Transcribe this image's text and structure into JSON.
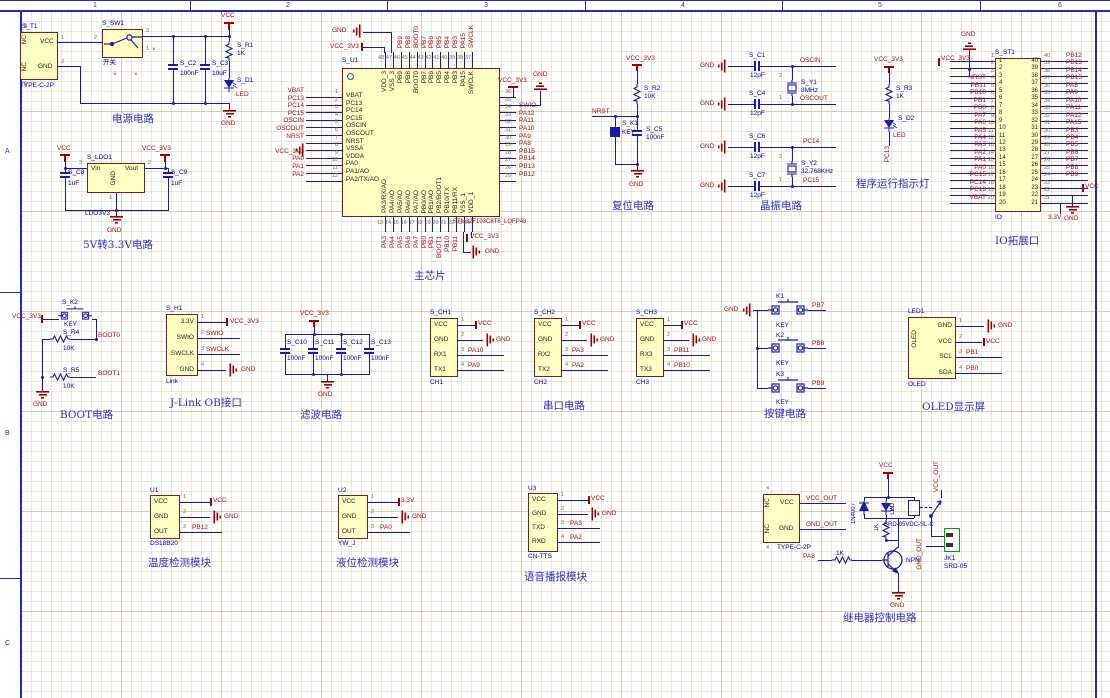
{
  "sheet": {
    "cols": [
      "1",
      "2",
      "3",
      "4",
      "5",
      "6"
    ],
    "rows": [
      "A",
      "B",
      "C"
    ]
  },
  "power": {
    "title": "电源电路",
    "vcc": "VCC",
    "gnd": "GND",
    "t1": {
      "ref": "S_T1",
      "part": "TYPE-C-2P",
      "nc": "NC",
      "vcc": "VCC",
      "gnd": "GND",
      "n1": "1",
      "n2": "2",
      "m0": "0"
    },
    "sw1": {
      "ref": "S_SW1",
      "val": "开关",
      "n1": "1",
      "n2": "2",
      "n3": "3"
    },
    "c2": {
      "ref": "S_C2",
      "val": "100nF"
    },
    "c3": {
      "ref": "S_C3",
      "val": "10uF"
    },
    "r1": {
      "ref": "S_R1",
      "val": "1K"
    },
    "d1": {
      "ref": "S_D1",
      "val": "LED"
    }
  },
  "ldo": {
    "title": "5V转3.3V电路",
    "vcc": "VCC",
    "vcc3v3": "VCC_3V3",
    "gnd": "GND",
    "ref": "S_LDO1",
    "part": "LDO3V3",
    "vin": "Vin",
    "vout": "Vout",
    "gndpin": "GND",
    "n1": "1",
    "n2": "2",
    "n3": "3",
    "c8": {
      "ref": "S_C8",
      "val": "1uF"
    },
    "c9": {
      "ref": "S_C9",
      "val": "1uF"
    }
  },
  "chip": {
    "ref": "S_U1",
    "part": "STM32F103C8T6_LQFP48",
    "title": "主芯片",
    "gnd": "GND",
    "vcc3v3": "VCC_3V3",
    "left": [
      {
        "n": "1",
        "name": "VBAT",
        "net": "VBAT"
      },
      {
        "n": "2",
        "name": "PC13",
        "net": "PC13"
      },
      {
        "n": "3",
        "name": "PC14",
        "net": "PC14"
      },
      {
        "n": "4",
        "name": "PC15",
        "net": "PC15"
      },
      {
        "n": "5",
        "name": "OSCIN",
        "net": "OSCIN"
      },
      {
        "n": "6",
        "name": "OSCOUT",
        "net": "OSCOUT"
      },
      {
        "n": "7",
        "name": "NRST",
        "net": "NRST"
      },
      {
        "n": "8",
        "name": "VSSA",
        "net": ""
      },
      {
        "n": "9",
        "name": "VDDA",
        "net": "VCC_3V3"
      },
      {
        "n": "10",
        "name": "PA0",
        "net": "PA0"
      },
      {
        "n": "11",
        "name": "PA1/AO",
        "net": "PA1"
      },
      {
        "n": "12",
        "name": "PA2/TX/AO",
        "net": "PA2"
      }
    ],
    "right": [
      {
        "n": "36",
        "name": "VDD_2",
        "net": ""
      },
      {
        "n": "35",
        "name": "VSS_2",
        "net": ""
      },
      {
        "n": "34",
        "name": "SWIO",
        "net": "SWIO"
      },
      {
        "n": "33",
        "name": "PA12/USB/DP",
        "net": "PA12"
      },
      {
        "n": "32",
        "name": "PA11/USB/DM",
        "net": "PA11"
      },
      {
        "n": "31",
        "name": "PA10/RX",
        "net": "PA10"
      },
      {
        "n": "30",
        "name": "PA9/TX",
        "net": "PA9"
      },
      {
        "n": "29",
        "name": "PA8",
        "net": "PA8"
      },
      {
        "n": "28",
        "name": "PB15",
        "net": "PB15"
      },
      {
        "n": "27",
        "name": "PB14",
        "net": "PB14"
      },
      {
        "n": "26",
        "name": "PB13",
        "net": "PB13"
      },
      {
        "n": "25",
        "name": "PB12",
        "net": "PB12"
      }
    ],
    "top": [
      {
        "n": "48",
        "name": "VDD_3",
        "net": ""
      },
      {
        "n": "47",
        "name": "VSS_3",
        "net": ""
      },
      {
        "n": "46",
        "name": "PB9",
        "net": "PB9"
      },
      {
        "n": "45",
        "name": "PB8",
        "net": "PB8"
      },
      {
        "n": "44",
        "name": "BOOT0",
        "net": "BOOT0"
      },
      {
        "n": "43",
        "name": "PB7",
        "net": "PB7"
      },
      {
        "n": "42",
        "name": "PB6",
        "net": "PB6"
      },
      {
        "n": "41",
        "name": "PB5",
        "net": "PB5"
      },
      {
        "n": "40",
        "name": "PB4",
        "net": "PB4"
      },
      {
        "n": "39",
        "name": "PB3",
        "net": "PB3"
      },
      {
        "n": "38",
        "name": "PA15",
        "net": "PA15"
      },
      {
        "n": "37",
        "name": "SWCLK",
        "net": "SWCLK"
      }
    ],
    "bottom": [
      {
        "n": "13",
        "name": "PA3/RX/AO",
        "net": "PA3"
      },
      {
        "n": "14",
        "name": "PA4/AO",
        "net": "PA4"
      },
      {
        "n": "15",
        "name": "PA5/AO",
        "net": "PA5"
      },
      {
        "n": "16",
        "name": "PA6/AO",
        "net": "PA6"
      },
      {
        "n": "17",
        "name": "PA7/AO",
        "net": "PA7"
      },
      {
        "n": "18",
        "name": "PB0/AO",
        "net": "PB0"
      },
      {
        "n": "19",
        "name": "PB1/AO",
        "net": "PB1"
      },
      {
        "n": "20",
        "name": "PB2/BOOT1",
        "net": "BOOT1"
      },
      {
        "n": "21",
        "name": "PB10/TX",
        "net": "PB10"
      },
      {
        "n": "22",
        "name": "PB11/RX",
        "net": "PB11"
      },
      {
        "n": "23",
        "name": "VSS_1",
        "net": ""
      },
      {
        "n": "24",
        "name": "VDD_1",
        "net": ""
      }
    ]
  },
  "reset": {
    "title": "复位电路",
    "vcc3v3": "VCC_3V3",
    "gnd": "GND",
    "nrst": "NRST",
    "r2": {
      "ref": "S_R2",
      "val": "10K"
    },
    "k1": {
      "ref": "S_K1",
      "val": "KEY"
    },
    "c5": {
      "ref": "S_C5",
      "val": "100nF"
    }
  },
  "crystal": {
    "title": "晶振电路",
    "gnd": "GND",
    "oscin": "OSCIN",
    "oscout": "OSCOUT",
    "pc14": "PC14",
    "pc15": "PC15",
    "c1": {
      "ref": "S_C1",
      "val": "12pF"
    },
    "c4": {
      "ref": "S_C4",
      "val": "12pF"
    },
    "c6": {
      "ref": "S_C6",
      "val": "12pF"
    },
    "c7": {
      "ref": "S_C7",
      "val": "12pF"
    },
    "y1": {
      "ref": "S_Y1",
      "val": "8MHz",
      "n1": "1",
      "n2": "2"
    },
    "y2": {
      "ref": "S_Y2",
      "val": "32.768KHz",
      "n1": "1",
      "n2": "2"
    }
  },
  "runled": {
    "title": "程序运行指示灯",
    "vcc3v3": "VCC_3V3",
    "r3": {
      "ref": "S_R3",
      "val": "1K"
    },
    "d2": {
      "ref": "S_D2",
      "val": "LED"
    },
    "net": "PC13"
  },
  "io": {
    "title": "IO拓展口",
    "ref": "S_ST1",
    "part": "IO",
    "gnd_top": "GND",
    "vcc3v3": "VCC_3V3",
    "vcc": "VCC",
    "gnd": "GND",
    "v33": "3.3V",
    "left": [
      {
        "n": "1",
        "net": ""
      },
      {
        "n": "2",
        "net": ""
      },
      {
        "n": "3",
        "net": ""
      },
      {
        "n": "4",
        "net": "NRST"
      },
      {
        "n": "5",
        "net": "PB11"
      },
      {
        "n": "6",
        "net": "PB10"
      },
      {
        "n": "7",
        "net": "PB1"
      },
      {
        "n": "8",
        "net": "PB0"
      },
      {
        "n": "9",
        "net": "PA7"
      },
      {
        "n": "10",
        "net": "PA6"
      },
      {
        "n": "11",
        "net": "PA5"
      },
      {
        "n": "12",
        "net": "PA4"
      },
      {
        "n": "13",
        "net": "PA3"
      },
      {
        "n": "14",
        "net": "PA2"
      },
      {
        "n": "15",
        "net": "PA1"
      },
      {
        "n": "16",
        "net": "PA0"
      },
      {
        "n": "17",
        "net": "PC15"
      },
      {
        "n": "18",
        "net": "PC14"
      },
      {
        "n": "19",
        "net": "PC13"
      },
      {
        "n": "20",
        "net": "VBAT"
      }
    ],
    "right": [
      {
        "n": "40",
        "net": "PB12"
      },
      {
        "n": "39",
        "net": "PB13"
      },
      {
        "n": "38",
        "net": "PB14"
      },
      {
        "n": "37",
        "net": "PB15"
      },
      {
        "n": "36",
        "net": "PA8"
      },
      {
        "n": "35",
        "net": "PA9"
      },
      {
        "n": "34",
        "net": "PA10"
      },
      {
        "n": "33",
        "net": "PA11"
      },
      {
        "n": "32",
        "net": "PA12"
      },
      {
        "n": "31",
        "net": "PA15"
      },
      {
        "n": "30",
        "net": "PB3"
      },
      {
        "n": "29",
        "net": "PB4"
      },
      {
        "n": "28",
        "net": "PB5"
      },
      {
        "n": "27",
        "net": "PB6"
      },
      {
        "n": "26",
        "net": "PB7"
      },
      {
        "n": "25",
        "net": "PB8"
      },
      {
        "n": "24",
        "net": "PB9"
      },
      {
        "n": "23",
        "net": ""
      },
      {
        "n": "22",
        "net": ""
      },
      {
        "n": "21",
        "net": ""
      }
    ]
  },
  "boot": {
    "title": "BOOT电路",
    "vcc3v3": "VCC_3V3",
    "gnd": "GND",
    "boot0": "BOOT0",
    "boot1": "BOOT1",
    "k2": {
      "ref": "S_K2",
      "val": "KEY"
    },
    "r4": {
      "ref": "S_R4",
      "val": "10K"
    },
    "r5": {
      "ref": "S_R5",
      "val": "10K"
    }
  },
  "jlink": {
    "title": "J-Link OB接口",
    "ref": "S_H1",
    "part": "Link",
    "pins": [
      {
        "n": "1",
        "name": "3.3V",
        "net": "VCC_3V3"
      },
      {
        "n": "2",
        "name": "SWIO",
        "net": "SWIO"
      },
      {
        "n": "3",
        "name": "SWCLK",
        "net": "SWCLK"
      },
      {
        "n": "4",
        "name": "GND",
        "net": "GND"
      }
    ]
  },
  "filter": {
    "title": "滤波电路",
    "vcc3v3": "VCC_3V3",
    "gnd": "GND",
    "caps": [
      {
        "ref": "S_C10",
        "val": "100nF"
      },
      {
        "ref": "S_C11",
        "val": "100nF"
      },
      {
        "ref": "S_C12",
        "val": "100nF"
      },
      {
        "ref": "S_C13",
        "val": "100nF"
      }
    ]
  },
  "serial": {
    "title": "串口电路",
    "ch1": {
      "ref": "S_CH1",
      "part": "CH1",
      "pins": [
        {
          "n": "1",
          "name": "VCC",
          "net": "VCC"
        },
        {
          "n": "2",
          "name": "GND",
          "net": "GND"
        },
        {
          "n": "3",
          "name": "RX1",
          "net": "PA10"
        },
        {
          "n": "4",
          "name": "TX1",
          "net": "PA9"
        }
      ]
    },
    "ch2": {
      "ref": "S_CH2",
      "part": "CH2",
      "pins": [
        {
          "n": "1",
          "name": "VCC",
          "net": "VCC"
        },
        {
          "n": "2",
          "name": "GND",
          "net": "GND"
        },
        {
          "n": "3",
          "name": "RX2",
          "net": "PA3"
        },
        {
          "n": "4",
          "name": "TX2",
          "net": "PA2"
        }
      ]
    },
    "ch3": {
      "ref": "S_CH3",
      "part": "CH3",
      "pins": [
        {
          "n": "1",
          "name": "VCC",
          "net": "VCC"
        },
        {
          "n": "2",
          "name": "GND",
          "net": "GND"
        },
        {
          "n": "3",
          "name": "RX3",
          "net": "PB11"
        },
        {
          "n": "4",
          "name": "TX3",
          "net": "PB10"
        }
      ]
    }
  },
  "keys": {
    "title": "按键电路",
    "gnd": "GND",
    "items": [
      {
        "ref": "K1",
        "val": "KEY",
        "net": "PB7"
      },
      {
        "ref": "K2",
        "val": "KEY",
        "net": "PB8"
      },
      {
        "ref": "K3",
        "val": "KEY",
        "net": "PB9"
      }
    ]
  },
  "oled": {
    "title": "OLED显示屏",
    "ref": "LED1",
    "part": "OLED",
    "inner": "OLED",
    "pins": [
      {
        "n": "1",
        "name": "GND",
        "net": "GND"
      },
      {
        "n": "2",
        "name": "VCC",
        "net": "VCC"
      },
      {
        "n": "3",
        "name": "SCL",
        "net": "PB1"
      },
      {
        "n": "4",
        "name": "SDA",
        "net": "PB0"
      }
    ]
  },
  "temp": {
    "title": "温度检测模块",
    "ref": "U1",
    "part": "DS18B20",
    "pins": [
      {
        "n": "1",
        "name": "VCC",
        "net": "VCC"
      },
      {
        "n": "2",
        "name": "GND",
        "net": "GND"
      },
      {
        "n": "3",
        "name": "OUT",
        "net": "PB12"
      }
    ]
  },
  "level": {
    "title": "液位检测模块",
    "ref": "U2",
    "part": "YW_J",
    "pins": [
      {
        "n": "1",
        "name": "VCC",
        "net": "3.3V"
      },
      {
        "n": "2",
        "name": "GND",
        "net": "GND"
      },
      {
        "n": "3",
        "name": "OUT",
        "net": "PA0"
      }
    ]
  },
  "voice": {
    "title": "语音播报模块",
    "ref": "U3",
    "part": "CN-TTS",
    "pins": [
      {
        "n": "1",
        "name": "VCC",
        "net": "VCC"
      },
      {
        "n": "2",
        "name": "GND",
        "net": "GND"
      },
      {
        "n": "3",
        "name": "TXD",
        "net": "PA3"
      },
      {
        "n": "4",
        "name": "RXD",
        "net": "PA2"
      }
    ]
  },
  "relay": {
    "title": "继电器控制电路",
    "vcc": "VCC",
    "gnd": "GND",
    "pa8": "PA8",
    "r_base": "1K",
    "npn": "NPN",
    "d": "1N4007",
    "led": "LED",
    "r_led": "1K",
    "relay_part": "SRD-05VDC-SL-C",
    "vcc_out": "VCC_OUT",
    "gnd_out": "GND_OUT",
    "conn": {
      "part": "TYPE-C-2P",
      "nc": "NC",
      "vcc": "VCC",
      "gnd": "GND"
    },
    "jk_ref": "JK1",
    "jk_part": "SRD-05"
  }
}
